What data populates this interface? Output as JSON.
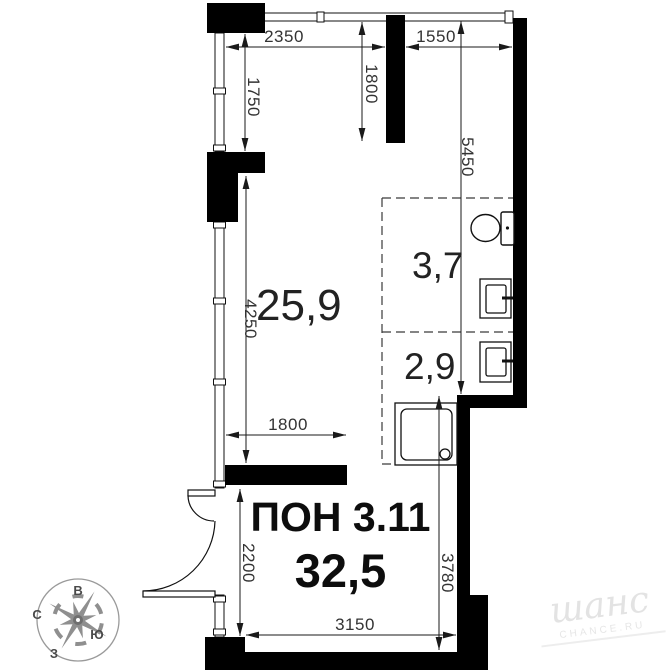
{
  "unit": {
    "name": "ПОН 3.11",
    "total_area": "32,5",
    "rooms": [
      {
        "id": "main-room",
        "area": "25,9"
      },
      {
        "id": "bathroom",
        "area": "3,7"
      },
      {
        "id": "shower-room",
        "area": "2,9"
      }
    ]
  },
  "dimensions": {
    "top_left_width": "2350",
    "top_right_width": "1550",
    "upper_window_height": "1750",
    "entry_zone_depth": "1800",
    "right_wall_height": "5450",
    "main_window_height": "4250",
    "opening_width": "1800",
    "door_wall_height": "2200",
    "bottom_width": "3150",
    "lower_right_height": "3780"
  },
  "compass": {
    "east": "В",
    "north": "С",
    "south": "Ю",
    "west": "З"
  },
  "watermark": {
    "logo_text": "шанс",
    "caption": "CHANCE.RU"
  },
  "colors": {
    "wall": "#000000",
    "line": "#1a1a1a",
    "dashed_zone": "#3a3a3a",
    "compass": "#8f8f8f",
    "watermark": "#e4e4e4"
  }
}
